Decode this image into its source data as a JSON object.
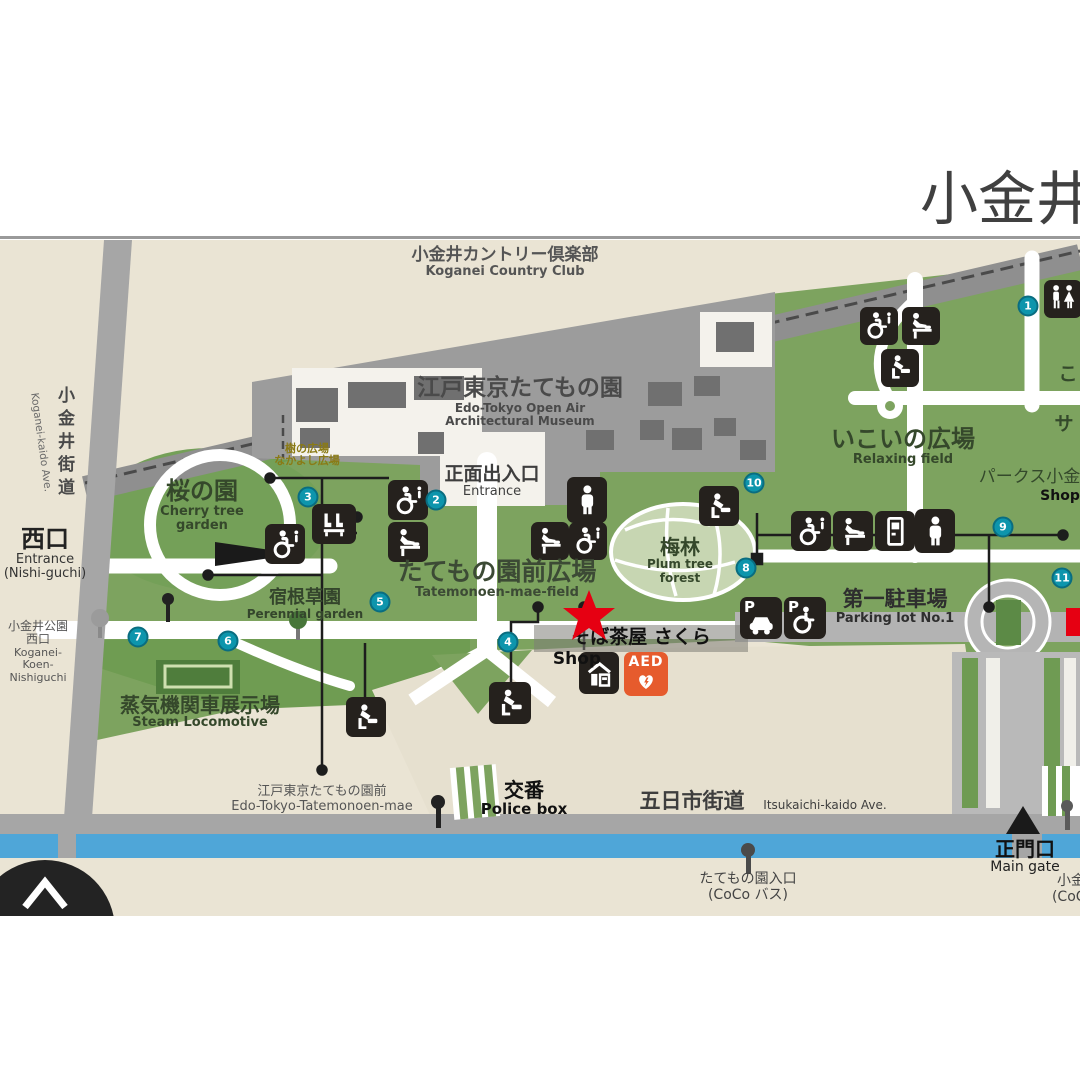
{
  "title": "小金井公園",
  "labels": {
    "country_club": {
      "jp": "小金井カントリー倶楽部",
      "en": "Koganei Country Club"
    },
    "museum": {
      "jp": "江戸東京たてもの園",
      "en1": "Edo-Tokyo Open Air",
      "en2": "Architectural Museum"
    },
    "main_entrance": {
      "jp": "正面出入口",
      "en": "Entrance"
    },
    "field": {
      "jp": "たてもの園前広場",
      "en": "Tatemonoen-mae-field"
    },
    "cherry": {
      "jp": "桜の園",
      "en1": "Cherry tree",
      "en2": "garden"
    },
    "nakayoshi": {
      "l1": "樹の広場",
      "l2": "なかよし広場"
    },
    "ikoi": {
      "jp": "いこいの広場",
      "en": "Relaxing field"
    },
    "plum": {
      "jp": "梅林",
      "en1": "Plum tree",
      "en2": "forest"
    },
    "perennial": {
      "jp": "宿根草園",
      "en": "Perennial garden"
    },
    "steam": {
      "jp": "蒸気機関車展示場",
      "en": "Steam Locomotive"
    },
    "west_gate": {
      "jp": "西口",
      "en1": "Entrance",
      "en2": "(Nishi-guchi)"
    },
    "koganei_kaido": {
      "jp": "小金井街道",
      "en": "Koganei-kaido Ave."
    },
    "nishiguchi_stop": {
      "l1": "小金井公園",
      "l2": "西口",
      "l3": "Koganei-",
      "l4": "Koen-",
      "l5": "Nishiguchi"
    },
    "parking1": {
      "jp": "第一駐車場",
      "en": "Parking lot No.1"
    },
    "soba": {
      "jp": "そば茶屋 さくら",
      "en": "Shop"
    },
    "parks_shop": {
      "jp": "パークス小金井",
      "en": "Shop"
    },
    "kids_partial1": "こ",
    "kids_partial2": "サ",
    "police": {
      "jp": "交番",
      "en": "Police box"
    },
    "itsukaichi": {
      "jp": "五日市街道",
      "en": "Itsukaichi-kaido Ave."
    },
    "edo_bus": {
      "jp": "江戸東京たてもの園前",
      "en": "Edo-Tokyo-Tatemonoen-mae"
    },
    "main_gate": {
      "jp": "正門口",
      "en": "Main gate"
    },
    "coco_stop": {
      "jp": "たてもの園入口",
      "en": "(CoCo バス)"
    },
    "right_stop": {
      "jp": "小金井公園",
      "en": "(CoCo バス)"
    }
  },
  "icons": {
    "parking_label": "P",
    "aed_label": "AED"
  },
  "markers": [
    {
      "n": "7",
      "x": 138,
      "y": 637
    },
    {
      "n": "6",
      "x": 228,
      "y": 641
    },
    {
      "n": "3",
      "x": 308,
      "y": 497
    },
    {
      "n": "2",
      "x": 436,
      "y": 500
    },
    {
      "n": "5",
      "x": 380,
      "y": 602
    },
    {
      "n": "4",
      "x": 508,
      "y": 642
    },
    {
      "n": "10",
      "x": 754,
      "y": 483
    },
    {
      "n": "8",
      "x": 746,
      "y": 568
    },
    {
      "n": "1",
      "x": 1028,
      "y": 306
    },
    {
      "n": "9",
      "x": 1003,
      "y": 527
    },
    {
      "n": "11",
      "x": 1062,
      "y": 578
    }
  ],
  "colors": {
    "park_green": "#7da35f",
    "dark_green": "#6e9b51",
    "museum_gray": "#9c9c9c",
    "building": "#707070",
    "road": "#a6a6a6",
    "water": "#4fa6d8",
    "beige": "#eae4d4",
    "marker_teal": "#0d95ac",
    "star_red": "#e60012",
    "aed_orange": "#e65b2d"
  }
}
